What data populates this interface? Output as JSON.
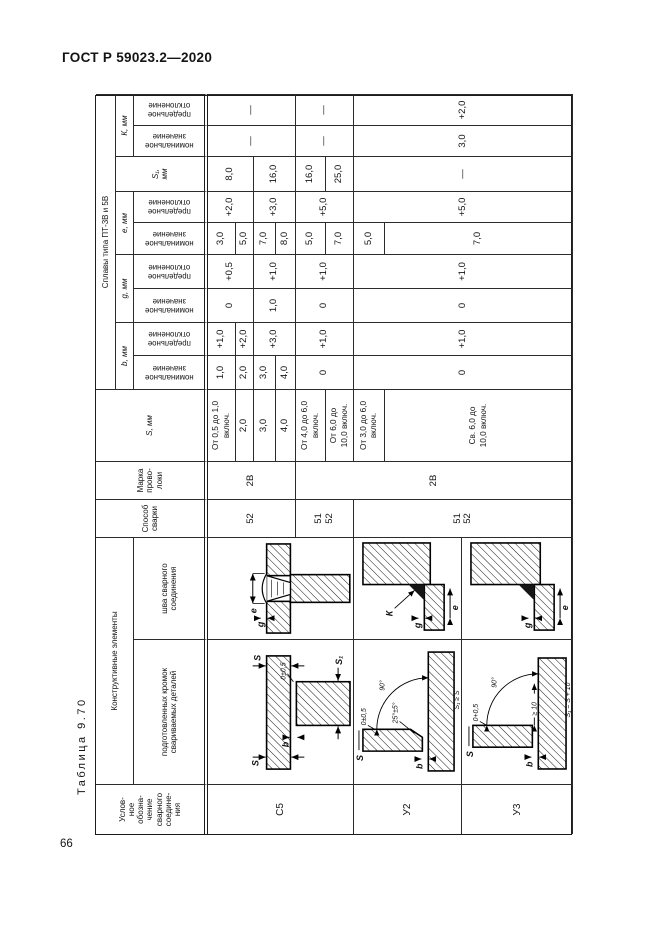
{
  "page": {
    "doc_header": "ГОСТ Р 59023.2—2020",
    "page_number": "66",
    "table_caption": "Таблица 9.70"
  },
  "header": {
    "joint_label": "Услов-\nное\nобозна-\nчение\nсварного\nсоедине-\nния",
    "constructive": "Конструктивные элементы",
    "prep": "подготовленных кромок\nсвариваемых деталей",
    "weld": "шва сварного\nсоединения",
    "method": "Способ\nсварки",
    "wire": "Марка\nпрово-\nлоки",
    "s": "S, мм",
    "alloys": "Сплавы типа ПТ-3В и 5В",
    "b": "b, мм",
    "g": "g, мм",
    "e": "е, мм",
    "s1": "S₁,\nмм",
    "k": "К, мм",
    "nominal": "номинальное\nзначение",
    "deviation": "предельное\nотклонение"
  },
  "cells": {
    "joint": [
      "С5",
      "У2",
      "У3"
    ],
    "method": [
      "52",
      "51\n52",
      "51\n52"
    ],
    "wire": [
      "2В",
      "2В"
    ],
    "s": [
      "От 0,5 до 1,0\nвключ.",
      "2,0",
      "3,0",
      "4,0",
      "От 4,0 до 6,0\nвключ.",
      "От 6,0 до\n10,0 включ.",
      "От 3,0 до 6,0\nвключ.",
      "Св. 6,0 до\n10,0 включ."
    ],
    "b_nom": [
      "1,0",
      "2,0",
      "3,0",
      "4,0",
      "0",
      "0"
    ],
    "b_dev": [
      "+1,0",
      "+2,0",
      "+3,0",
      "+1,0",
      "+1,0"
    ],
    "g_nom": [
      "0",
      "1,0",
      "0",
      "0"
    ],
    "g_dev": [
      "+0,5",
      "+1,0",
      "+1,0",
      "+1,0"
    ],
    "e_nom": [
      "3,0",
      "5,0",
      "7,0",
      "8,0",
      "5,0",
      "7,0",
      "5,0",
      "7,0"
    ],
    "e_dev": [
      "+2,0",
      "+3,0",
      "+5,0",
      "+5,0"
    ],
    "s1": [
      "8,0",
      "16,0",
      "16,0",
      "25,0",
      "—"
    ],
    "k_nom": [
      "—",
      "—",
      "3,0"
    ],
    "k_dev": [
      "—",
      "—",
      "+2,0"
    ]
  },
  "diagrams": {
    "c5_prep": {
      "s_left": "S",
      "s_right": "S",
      "b": "b",
      "s1": "S₁",
      "tol": "0±0,5"
    },
    "c5_weld": {
      "g": "g",
      "e": "е"
    },
    "u2_weld": {
      "g": "g",
      "e": "е",
      "k": "К"
    },
    "u3_weld": {
      "g": "g",
      "e": "е"
    },
    "u2_prep": {
      "s": "S",
      "b": "b",
      "angle": "90°",
      "bevel": "25°±5°",
      "tol": "0±0,5",
      "s1": "S₁ ≥ S"
    },
    "u3_prep": {
      "s": "S",
      "b": "b",
      "angle": "90°",
      "tol": "0+0,5",
      "edge": "≥ 10",
      "s1": "S₁ = S + 10"
    }
  }
}
